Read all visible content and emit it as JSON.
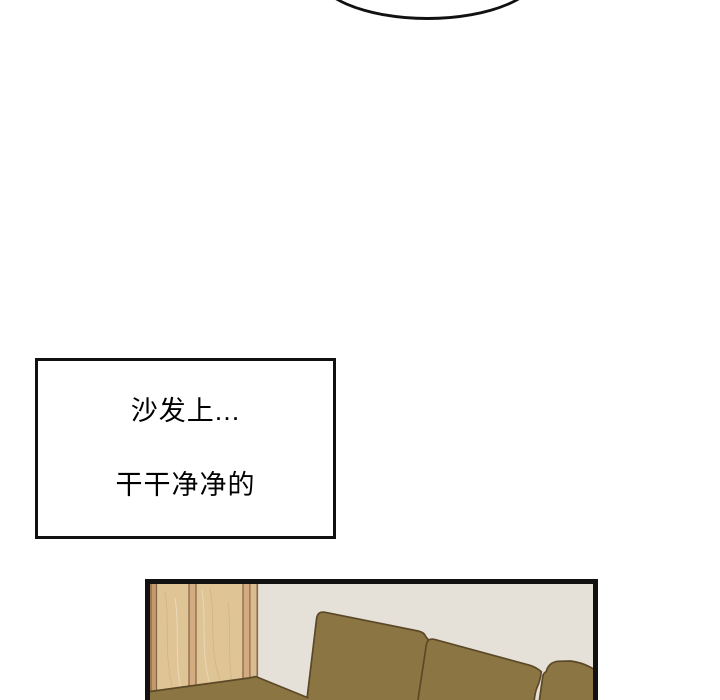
{
  "speech_bubble": {
    "visible_text": ""
  },
  "narration_box": {
    "line1": "沙发上...",
    "line2": "干干净净的"
  },
  "colors": {
    "outline": "#111111",
    "wall": "#e5e0d8",
    "sofa_base": "#8b7542",
    "sofa_line": "#5b4827",
    "wood_plank": "#dfc596",
    "wood_strip": "#c39a6c",
    "wood_sep": "#d2ac80",
    "wood_side": "#d9bd8f",
    "wood_line": "#8a6848",
    "paper": "#ffffff",
    "ink": "#000000"
  }
}
